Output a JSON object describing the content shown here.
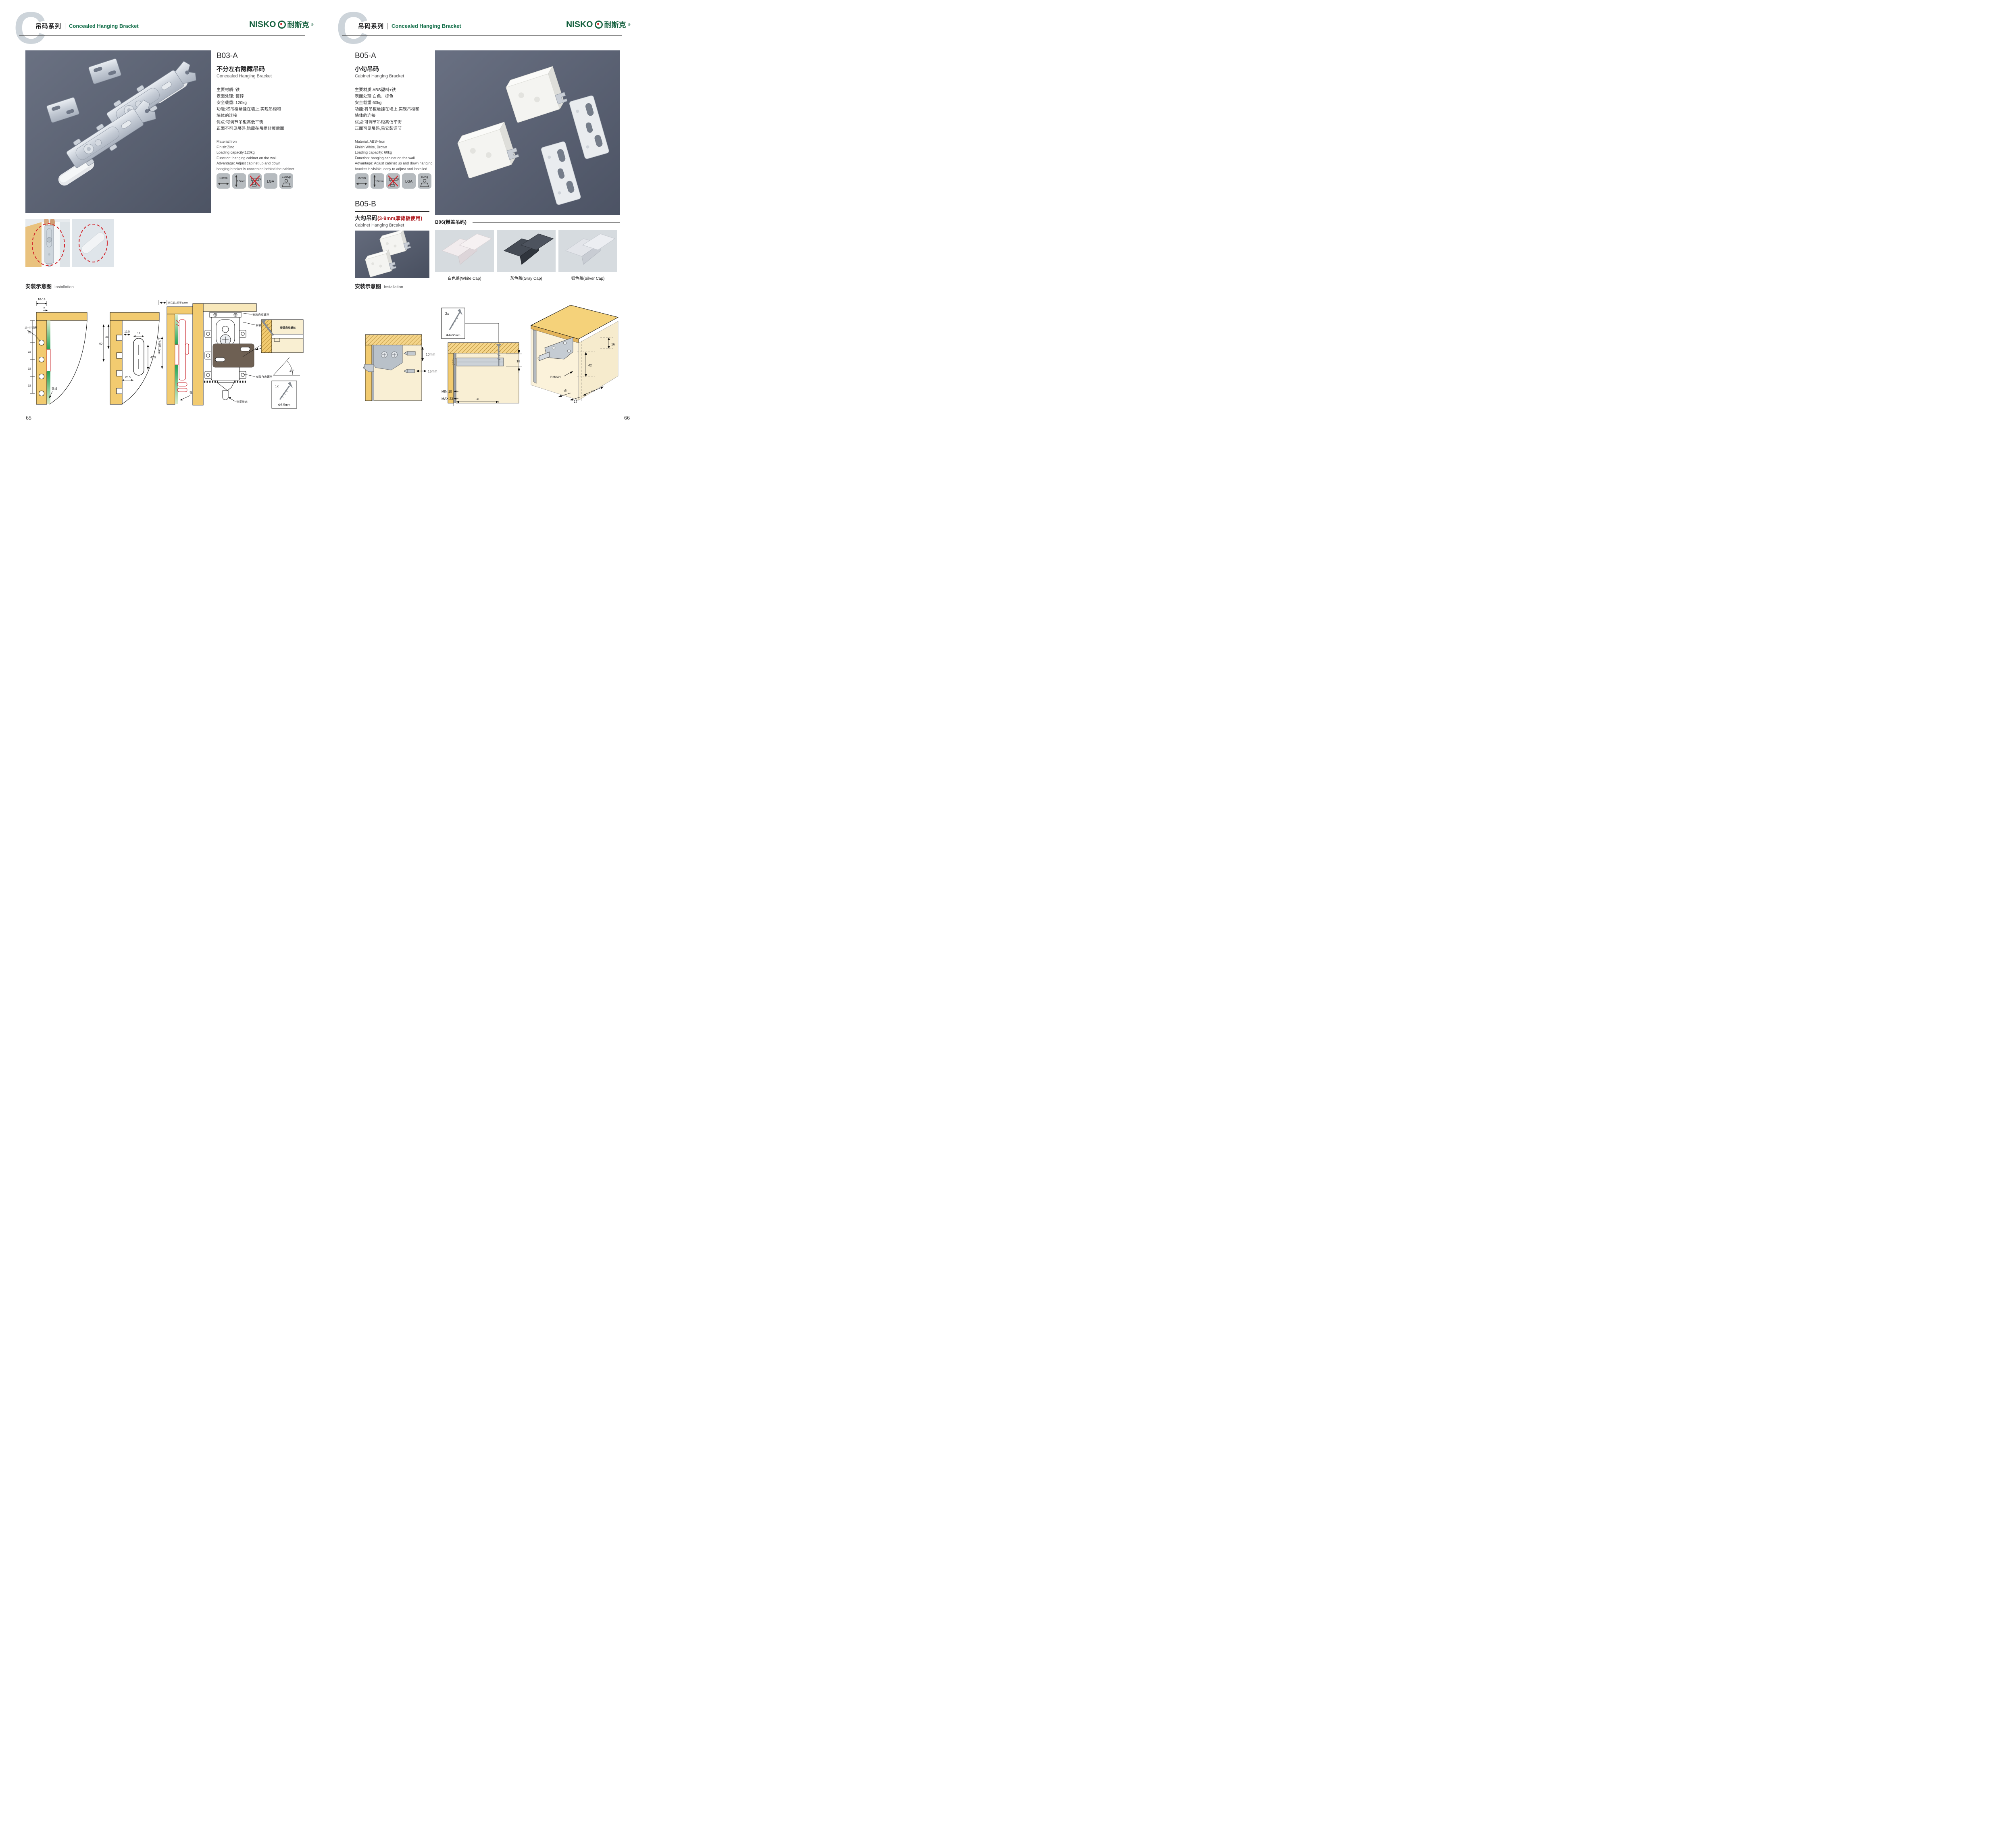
{
  "meta": {
    "accent_green": "#0e6b45",
    "brand_green": "#14603e",
    "brand_red": "#d42027",
    "photo_background": "#5a6173",
    "diagram_wood": "#f2cb70",
    "diagram_red": "#c81e25"
  },
  "header": {
    "letter": "C",
    "series_zh": "吊码系列",
    "series_en": "Concealed Hanging Bracket",
    "brand_en": "NISKO",
    "brand_zh": "耐斯克",
    "brand_reg": "®"
  },
  "installation": {
    "zh": "安装示意图",
    "en": "Installation"
  },
  "page_numbers": {
    "left": "65",
    "right": "66"
  },
  "products": {
    "b03a": {
      "code": "B03-A",
      "name_zh": "不分左右隐藏吊码",
      "name_en": "Concealed Hanging Bracket",
      "specs_zh": [
        "主要材质: 铁",
        "表面处理: 镀锌",
        "安全载重: 120kg",
        "功能:将吊柜悬挂在墙上,实现吊柜和",
        "墙体的连接",
        "优点:可调节吊柜高低平衡",
        "正面不可见吊码,隐藏在吊柜背板后面"
      ],
      "specs_en": [
        "Material:Iron",
        "Finish:Zinc",
        "Loading capacity:120kg",
        "Function: hanging cabinet on the wall",
        "Advantage: Adjust cabinet up and down",
        "hanging bracket is concealed behind the cabinet"
      ],
      "icons": {
        "width": "10mm",
        "height": "10mm",
        "cert": "LGA",
        "load": "120Kg"
      }
    },
    "b05a": {
      "code": "B05-A",
      "name_zh": "小勾吊码",
      "name_en": "Cabinet Hanging Bracket",
      "specs_zh": [
        "主要材质:ABS塑料+铁",
        "表面处理:白色、棕色",
        "安全载重:60kg",
        "功能:将吊柜悬挂在墙上,实现吊柜和",
        "墙体的连接",
        "优点:可调节吊柜高低平衡",
        "正面可见吊码,易安装调节"
      ],
      "specs_en": [
        "Material: ABS+Iron",
        "Finish:White, Brown",
        "Loading capacity: 60kg",
        "Function: hanging cabinet on the wall",
        "Advantage: Adjust cabinet up and down hanging",
        "bracket is visible, easy to adjust and installed"
      ],
      "icons": {
        "width": "15mm",
        "height": "10mm",
        "cert": "LGA",
        "load": "60Kg"
      }
    },
    "b05b": {
      "code": "B05-B",
      "name_zh": "大勾吊码",
      "name_note": "(3-9mm厚背板使用)",
      "name_en": "Cabinet Hanging Brcaket"
    },
    "b06": {
      "label": "B06(带盖吊码)",
      "caps": [
        "白色盖(White Cap)",
        "灰色盖(Gray Cap)",
        "银色盖(Silver Cap)"
      ]
    }
  },
  "diagrams_left": {
    "d1": {
      "dims": [
        "16-18",
        "5",
        "35",
        "32",
        "32",
        "32"
      ],
      "labels": [
        "10-4个均布",
        "背板"
      ]
    },
    "d2": {
      "dims": [
        "60",
        "35",
        "12.5",
        "12",
        "42.5",
        "20.5"
      ]
    },
    "d3": {
      "labels": [
        "前后最大调节10mm",
        "上下调节10mm",
        "背板"
      ]
    },
    "d4": {
      "labels": [
        "安装自攻螺丝",
        "安装自攻螺丝",
        "专用挂片",
        "安装自攻螺丝",
        "锁紧状态"
      ],
      "detail_label": "安装自攻螺丝",
      "angle": "45°",
      "qty": "1x",
      "dia": "Φ3.5mm"
    }
  },
  "diagrams_right": {
    "d1": {
      "dims": [
        "10mm",
        "15mm"
      ]
    },
    "d2": {
      "qty": "2x",
      "dia": "Φ4×30mm",
      "dims": [
        "18",
        "MIN.10",
        "MAX.23",
        "58"
      ]
    },
    "d3": {
      "dims": [
        "16",
        "42",
        "RMAX4",
        "16",
        "17",
        "32"
      ]
    }
  }
}
